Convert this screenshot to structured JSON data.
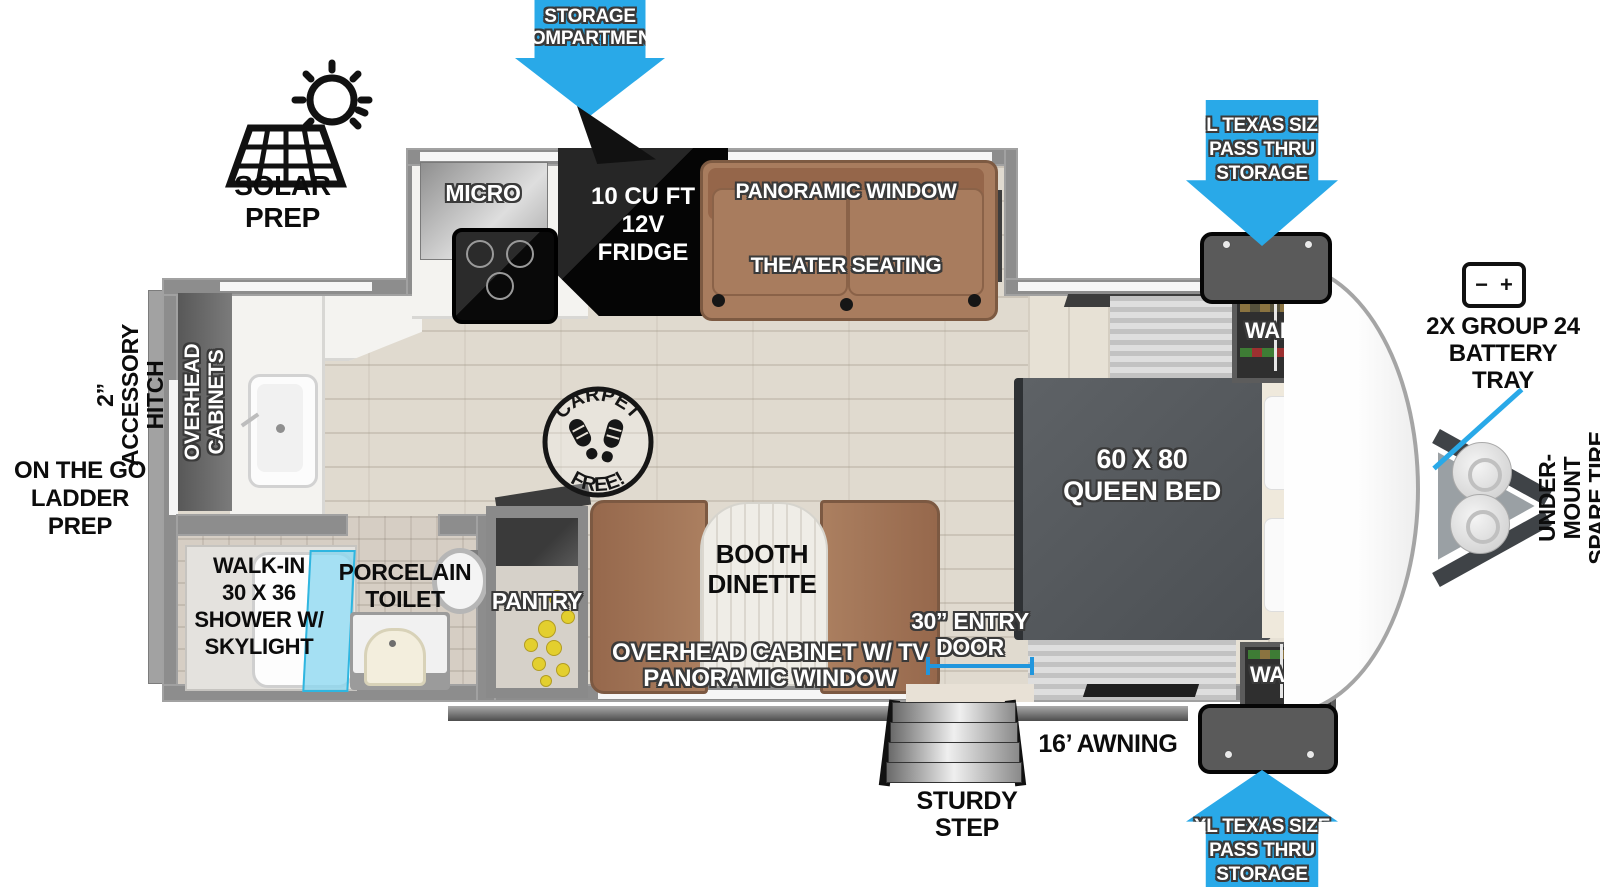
{
  "colors": {
    "arrow_blue": "#29a9e8",
    "dimension_blue": "#2196dd",
    "seat_brown": "#a87c5e",
    "bed_gray": "#565a5e"
  },
  "exterior": {
    "solar_prep": {
      "label": "SOLAR PREP"
    },
    "storage_compartment": {
      "line1": "STORAGE",
      "line2": "COMPARTMENT"
    },
    "pass_thru_top": {
      "line1": "XL TEXAS SIZE",
      "line2": "PASS THRU",
      "line3": "STORAGE"
    },
    "pass_thru_bottom": {
      "line1": "XL TEXAS SIZE",
      "line2": "PASS THRU",
      "line3": "STORAGE"
    },
    "battery_tray": {
      "line1": "2X GROUP 24",
      "line2": "BATTERY",
      "line3": "TRAY",
      "icon_minus": "−",
      "icon_plus": "+"
    },
    "spare_tire": {
      "line1": "UNDER-MOUNT",
      "line2": "SPARE TIRE"
    },
    "accessory_hitch": {
      "line1": "2” ACCESSORY",
      "line2": "HITCH"
    },
    "ladder_prep": {
      "line1": "ON THE GO",
      "line2": "LADDER PREP"
    },
    "awning": {
      "label": "16’ AWNING"
    },
    "entry_door": {
      "line1": "30” ENTRY",
      "line2": "DOOR"
    },
    "sturdy_step": {
      "line1": "STURDY",
      "line2": "STEP"
    }
  },
  "interior": {
    "micro": "MICRO",
    "fridge": {
      "line1": "10 CU FT",
      "line2": "12V",
      "line3": "FRIDGE"
    },
    "panoramic_window_top": "PANORAMIC WINDOW",
    "theater_seating": "THEATER SEATING",
    "ward_top": "WARD",
    "ward_bottom": "WARD",
    "overhead_cabinets_bed": "OVERHEAD CABINETS",
    "queen_bed": {
      "line1": "60 X 80",
      "line2": "QUEEN BED"
    },
    "overhead_cabinets_rear": {
      "line1": "OVERHEAD",
      "line2": "CABINETS"
    },
    "carpet_free": {
      "top": "CARPET",
      "bottom": "FREE!"
    },
    "booth_dinette": {
      "line1": "BOOTH",
      "line2": "DINETTE"
    },
    "overhead_cabinet_tv": "OVERHEAD CABINET W/ TV",
    "panoramic_window_bottom": "PANORAMIC WINDOW",
    "pantry": "PANTRY",
    "porcelain_toilet": {
      "line1": "PORCELAIN",
      "line2": "TOILET"
    },
    "shower": {
      "line1": "WALK-IN",
      "line2": "30 X 36",
      "line3": "SHOWER W/",
      "line4": "SKYLIGHT"
    }
  }
}
